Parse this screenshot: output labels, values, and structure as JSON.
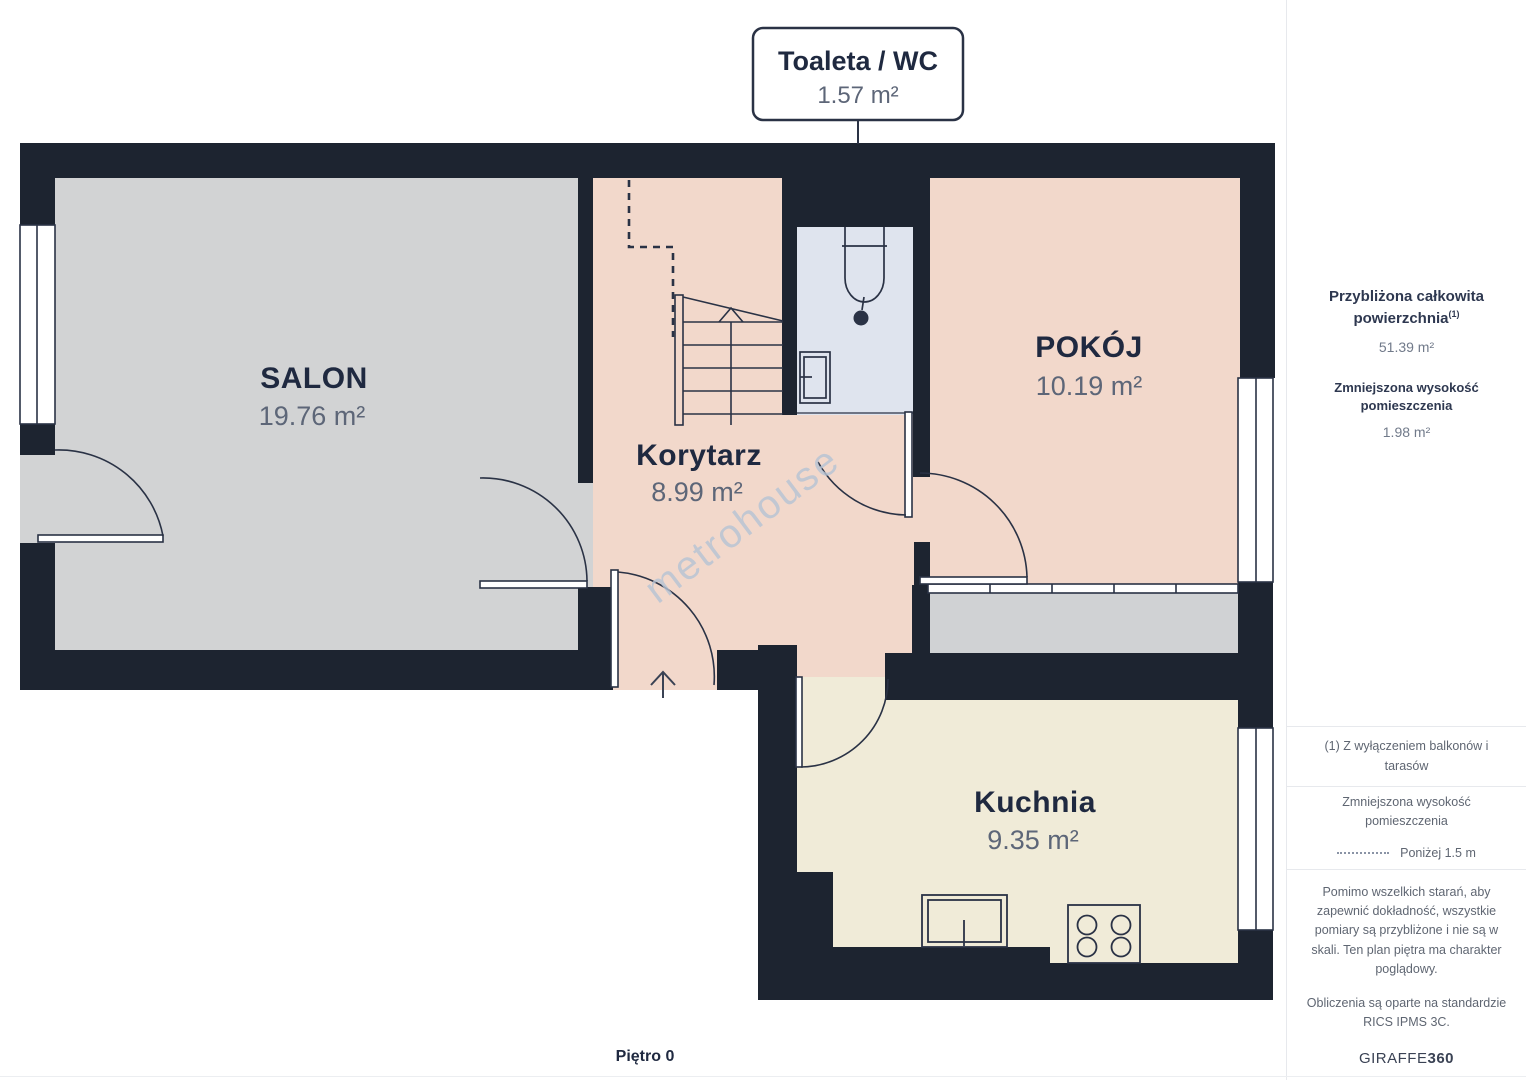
{
  "callout": {
    "title": "Toaleta / WC",
    "area": "1.57 m²"
  },
  "rooms": {
    "salon": {
      "name": "SALON",
      "area": "19.76 m²"
    },
    "korytarz": {
      "name": "Korytarz",
      "area": "8.99 m²"
    },
    "pokoj": {
      "name": "POKÓJ",
      "area": "10.19 m²"
    },
    "kuchnia": {
      "name": "Kuchnia",
      "area": "9.35 m²"
    }
  },
  "watermark": "metrohouse",
  "floor_label": "Piętro 0",
  "sidebar": {
    "total_area_label": "Przybliżona całkowita powierzchnia",
    "total_area_marker": "(1)",
    "total_area_value": "51.39 m²",
    "reduced_height_label": "Zmniejszona wysokość pomieszczenia",
    "reduced_height_value": "1.98 m²",
    "footnote": "(1) Z wyłączeniem balkonów i tarasów",
    "legend_label": "Zmniejszona wysokość pomieszczenia",
    "legend_value": "Poniżej 1.5 m",
    "disclaimer": "Pomimo wszelkich starań, aby zapewnić dokładność, wszystkie pomiary są przybliżone i nie są w skali. Ten plan piętra ma charakter poglądowy.",
    "standard_note": "Obliczenia są oparte na standardzie RICS IPMS 3C.",
    "brand": "GIRAFFE",
    "brand_bold": "360"
  },
  "colors": {
    "wall": "#1d2430",
    "salon_floor": "#d2d3d4",
    "corridor_floor": "#f2d8cb",
    "room_floor": "#f2d8cb",
    "kitchen_floor": "#f0ebd8",
    "toilet_floor": "#dfe4ee",
    "balcony_floor": "#d0d2d4",
    "outline": "#2a3245",
    "room_name_text": "#1f2940",
    "room_area_text": "#5d6678",
    "watermark_text": "#b6c3d4"
  }
}
